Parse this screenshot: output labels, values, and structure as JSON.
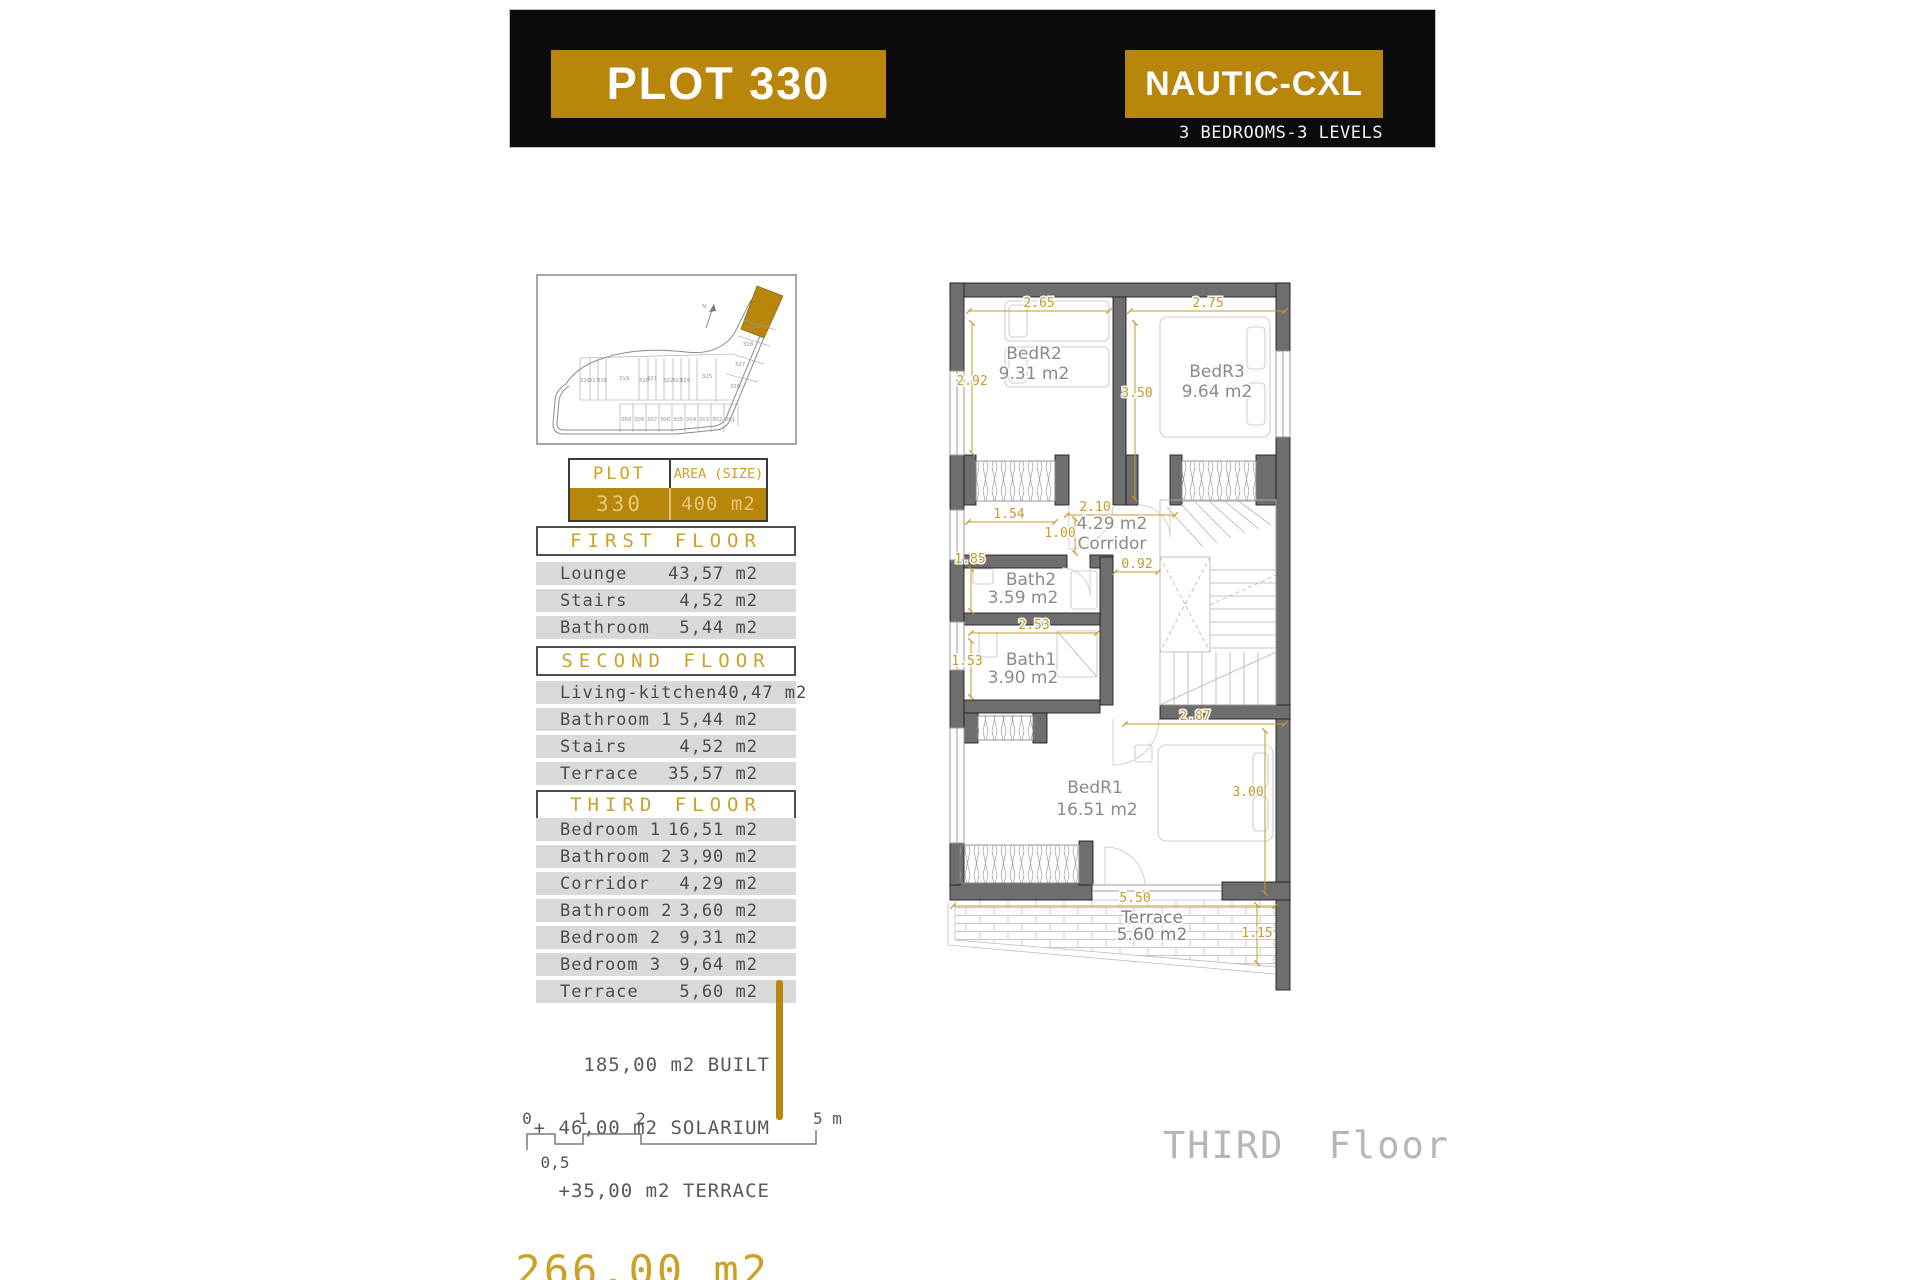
{
  "header": {
    "plot_title": "PLOT 330",
    "model_title": "NAUTIC-CXL",
    "subtitle": "3 BEDROOMS-3 LEVELS"
  },
  "site_plan": {
    "north_label": "N",
    "highlighted_plot": "330",
    "row_top": [
      "316",
      "317",
      "318",
      "319",
      "320",
      "321",
      "322",
      "323",
      "324",
      "325"
    ],
    "row_arm": [
      "326",
      "327",
      "328",
      "329"
    ],
    "row_bottom": [
      "309",
      "308",
      "307",
      "306",
      "305",
      "304",
      "303",
      "302",
      "301"
    ]
  },
  "plot_table": {
    "plot_header": "PLOT",
    "area_header": "AREA (SIZE)",
    "plot_value": "330",
    "area_value": "400 m2"
  },
  "floors": [
    {
      "title": "FIRST FLOOR",
      "rows": [
        {
          "label": "Lounge",
          "value": "43,57 m2"
        },
        {
          "label": "Stairs",
          "value": "4,52 m2"
        },
        {
          "label": "Bathroom",
          "value": "5,44 m2"
        }
      ]
    },
    {
      "title": "SECOND FLOOR",
      "rows": [
        {
          "label": "Living-kitchen",
          "value": "40,47 m2"
        },
        {
          "label": "Bathroom 1",
          "value": "5,44 m2"
        },
        {
          "label": "Stairs",
          "value": "4,52 m2"
        },
        {
          "label": "Terrace",
          "value": "35,57 m2"
        }
      ]
    },
    {
      "title": "THIRD FLOOR",
      "rows": [
        {
          "label": "Bedroom 1",
          "value": "16,51 m2"
        },
        {
          "label": "Bathroom 2",
          "value": "3,90 m2"
        },
        {
          "label": "Corridor",
          "value": "4,29 m2"
        },
        {
          "label": "Bathroom 2",
          "value": "3,60 m2"
        },
        {
          "label": "Bedroom 2",
          "value": "9,31 m2"
        },
        {
          "label": "Bedroom 3",
          "value": "9,64 m2"
        },
        {
          "label": "Terrace",
          "value": "5,60 m2"
        }
      ]
    }
  ],
  "totals": {
    "built": "185,00 m2 BUILT",
    "solarium": "+ 46,00 m2 SOLARIUM",
    "terrace": "+35,00 m2 TERRACE",
    "total": "266,00 m2"
  },
  "scale_bar": {
    "tick0": "0",
    "tick1": "1",
    "tick2": "2",
    "tick5": "5 m",
    "half": "0,5"
  },
  "plan": {
    "caption": "THIRD Floor",
    "rooms": {
      "bedr2": {
        "name": "BedR2",
        "area": "9.31 m2"
      },
      "bedr3": {
        "name": "BedR3",
        "area": "9.64 m2"
      },
      "corridor": {
        "area": "4.29 m2",
        "name": "Corridor"
      },
      "bath2": {
        "name": "Bath2",
        "area": "3.59 m2"
      },
      "bath1": {
        "name": "Bath1",
        "area": "3.90 m2"
      },
      "bedr1": {
        "name": "BedR1",
        "area": "16.51 m2"
      },
      "terrace": {
        "name": "Terrace",
        "area": "5.60 m2"
      }
    },
    "dims": {
      "top_left": "2.65",
      "top_right": "2.75",
      "left_upper": "2.92",
      "center_vert": "3.50",
      "wardrobe": "1.54",
      "corridor_w": "2.10",
      "corridor_h": "1.00",
      "left_bath2": "1.85",
      "hall": "0.92",
      "bath1_w": "2.53",
      "left_bath1": "1.53",
      "bedr1_n": "2.87",
      "bedr1_e": "3.00",
      "terrace_w": "5.50",
      "terrace_e": "1.15"
    }
  },
  "colors": {
    "gold": "#B8860B",
    "gold_text": "#C9A227",
    "row_gray": "#D9D9D9"
  }
}
